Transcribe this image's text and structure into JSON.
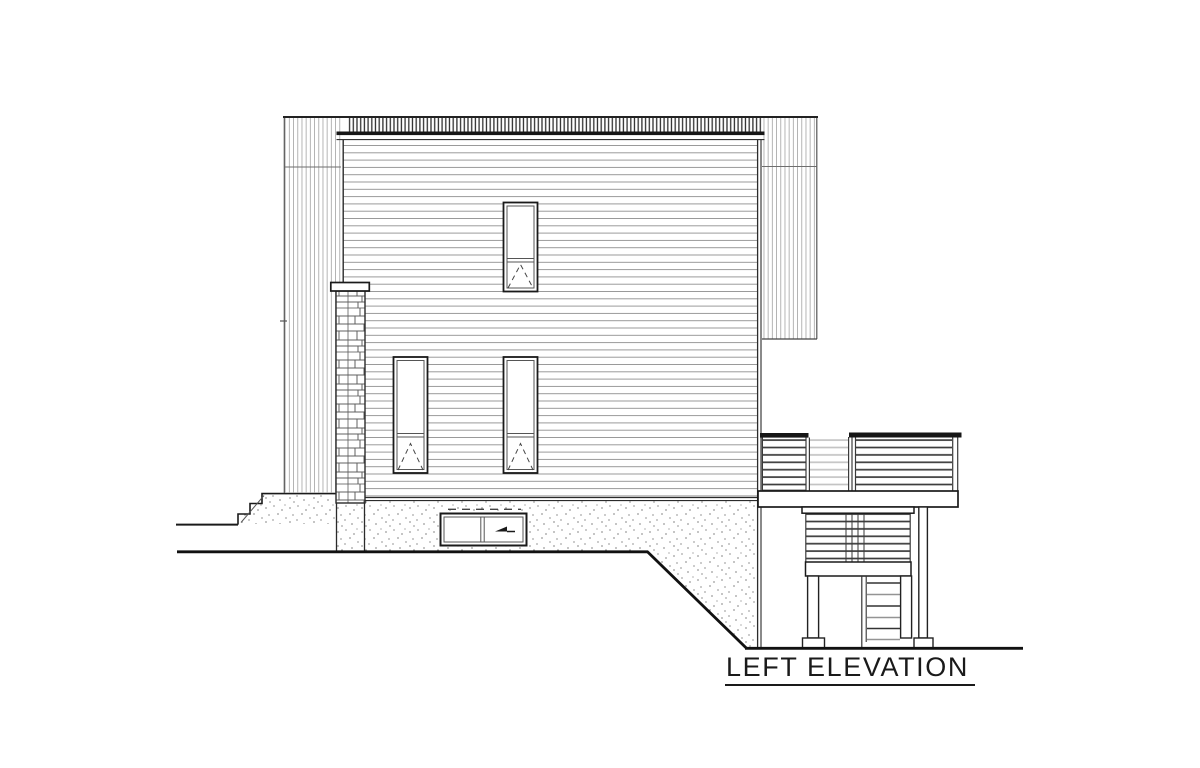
{
  "drawing": {
    "label": "LEFT ELEVATION",
    "type_note": "architectural side elevation drawing",
    "colors": {
      "paper": "#ffffff",
      "ink": "#1a1a1a",
      "mid": "#555555",
      "light": "#9a9a9a",
      "siding": "#8f8f8f",
      "strip": "#a8a8a8",
      "batten": "#2f2f2f",
      "slat": "#3c3c3c",
      "slatfaint": "#c4c4c4",
      "dot": "#4a4a4a",
      "stone": "#5a5a5a"
    }
  }
}
